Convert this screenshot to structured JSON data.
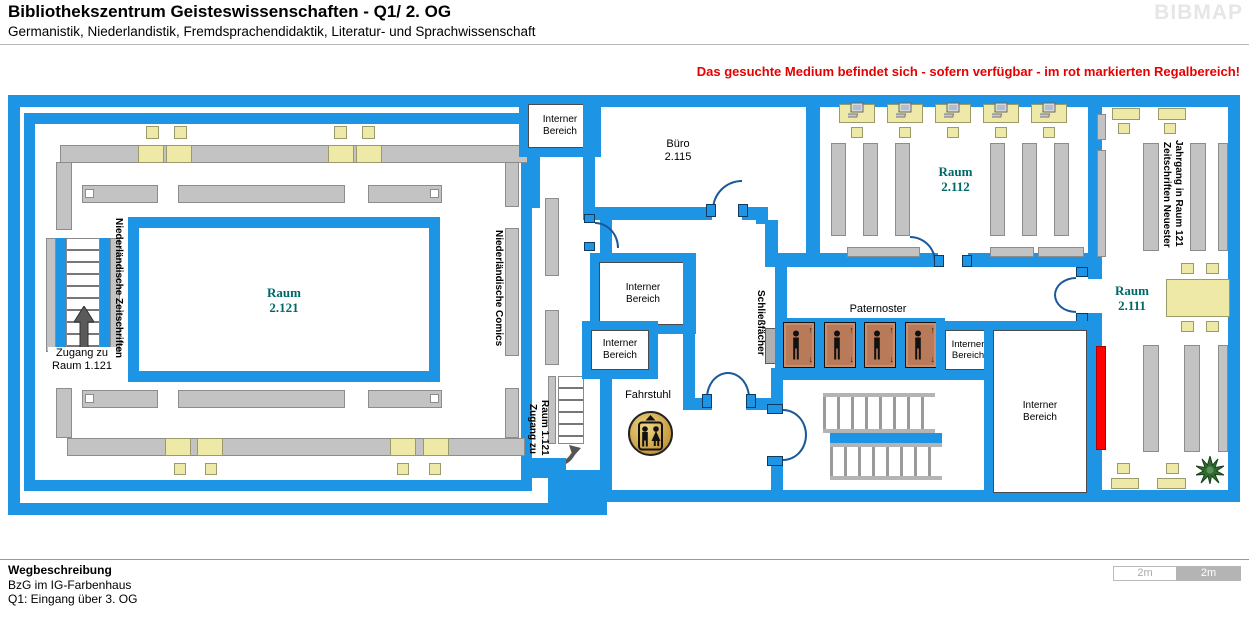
{
  "header": {
    "title": "Bibliothekszentrum Geisteswissenschaften - Q1/ 2. OG",
    "subtitle": "Germanistik, Niederlandistik, Fremdsprachendidaktik, Literatur- und Sprachwissenschaft",
    "brand": "BIBMAP",
    "notice": "Das gesuchte Medium befindet sich - sofern verfügbar -  im rot markierten Regalbereich!"
  },
  "rooms": {
    "r2121": {
      "name": "Raum",
      "nr": "2.121"
    },
    "r2112": {
      "name": "Raum",
      "nr": "2.112"
    },
    "r2111": {
      "name": "Raum",
      "nr": "2.111"
    },
    "buero": {
      "name": "Büro",
      "nr": "2.115"
    }
  },
  "labels": {
    "interner": {
      "l1": "Interner",
      "l2": "Bereich"
    },
    "fahrstuhl": "Fahrstuhl",
    "paternoster": "Paternoster",
    "schliessfaecher": "Schließfächer",
    "zugang": {
      "l1": "Zugang zu",
      "l2": "Raum 1.121"
    },
    "nl_zeitschriften": "Niederländische Zeitschriften",
    "nl_comics": "Niederländische Comics",
    "zs_neuester": "Zeitschriften Neuester",
    "zs_jahrgang": "Jahrgang in Raum 121"
  },
  "footer": {
    "heading": "Wegbeschreibung",
    "line1": "BzG im IG-Farbenhaus",
    "line2": "Q1: Eingang über 3. OG",
    "scale_left": "2m",
    "scale_right": "2m"
  },
  "colors": {
    "wall_blue": "#1e94e4",
    "shelf_gray": "#c3c3c3",
    "furniture_yellow": "#efe9a7",
    "room_label_teal": "#006868",
    "highlight_red": "#ff0000",
    "paternoster_brown": "#b87a58",
    "notice_red": "#e60000"
  }
}
